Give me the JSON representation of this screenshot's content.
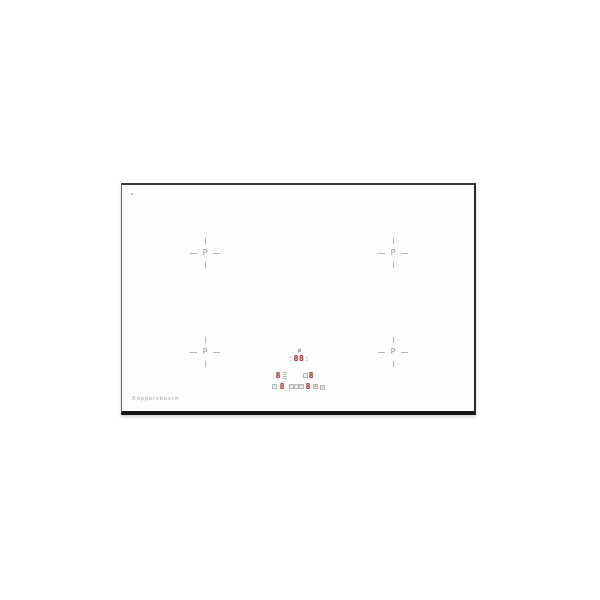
{
  "product": {
    "description": "White glass induction cooktop, front product view",
    "brand_logo": "Küppersbusch"
  },
  "zones": [
    {
      "id": "rear-left",
      "marker": "P"
    },
    {
      "id": "rear-right",
      "marker": "P"
    },
    {
      "id": "front-left",
      "marker": "P"
    },
    {
      "id": "front-right",
      "marker": "P"
    }
  ],
  "timer_display": {
    "left_colon": ":",
    "value": "88",
    "right_colon": ":"
  },
  "power_displays": {
    "rear_left": "8",
    "rear_right": "8",
    "front_left": "8",
    "front_right": "8"
  },
  "icons": {
    "power_level_bars": "",
    "zone_indicator": "",
    "lock": "•",
    "timer_minus": "−",
    "timer_clock": "◦",
    "timer_plus": "+",
    "pause": "▪",
    "power": "○"
  },
  "colors": {
    "accent_red": "#a03636",
    "marker_gray": "#b3b6b8",
    "icon_gray": "#b6b9bb",
    "frame_dark": "#141414",
    "surface": "#fdfdfd",
    "logo_gray": "#c6c7c8"
  }
}
